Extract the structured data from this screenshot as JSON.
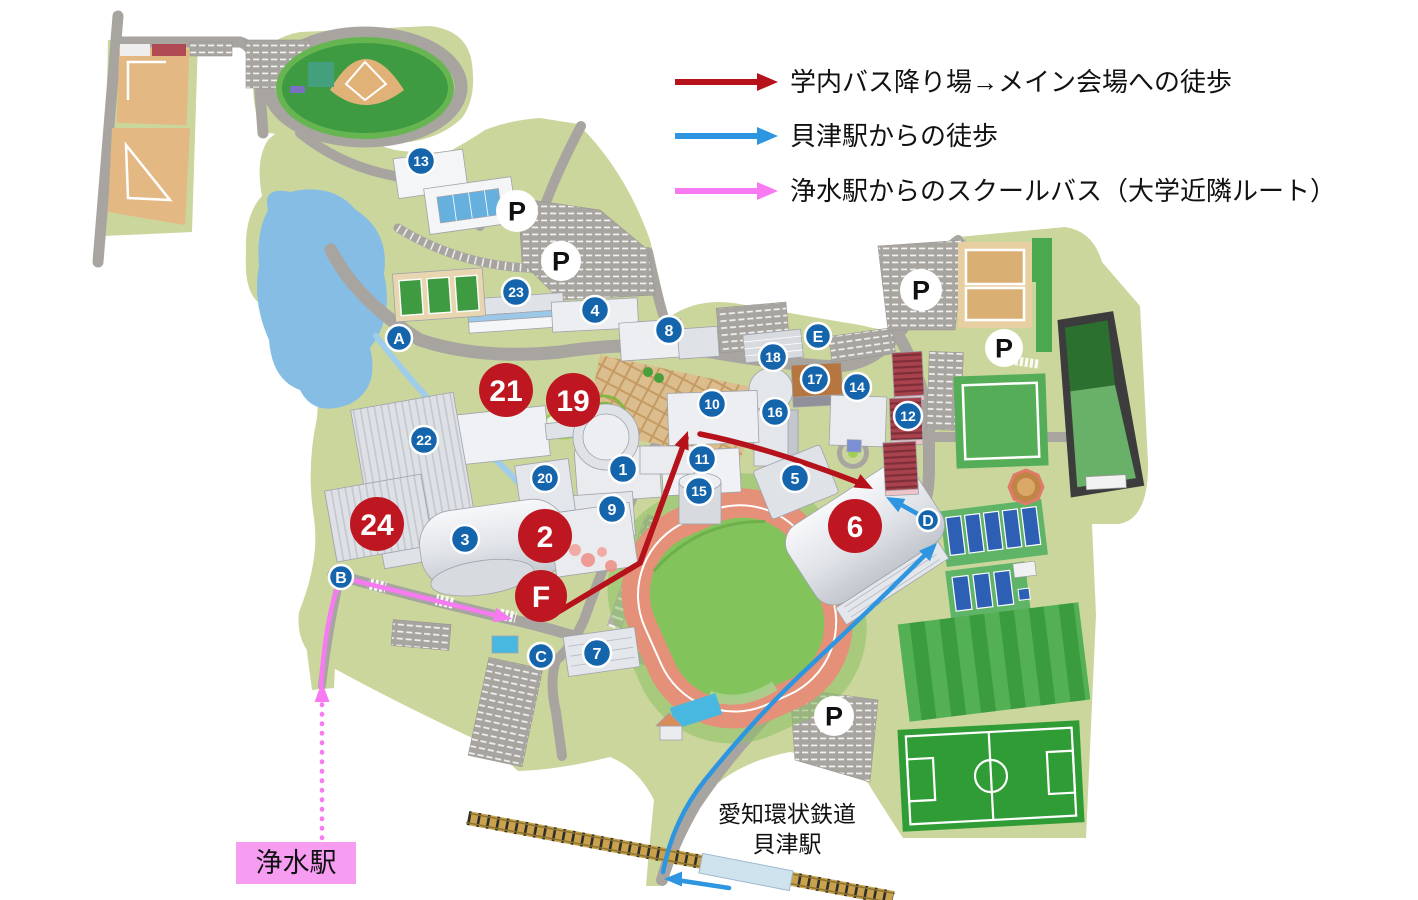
{
  "legend": {
    "items": [
      {
        "id": "campus-bus-walk",
        "color": "#b5121b",
        "label": "学内バス降り場→メイン会場への徒歩"
      },
      {
        "id": "kaizu-station-walk",
        "color": "#2e96e0",
        "label": "貝津駅からの徒歩"
      },
      {
        "id": "josui-school-bus",
        "color": "#f87af2",
        "label": "浄水駅からのスクールバス（大学近隣ルート）"
      }
    ]
  },
  "stations": {
    "josui": "浄水駅",
    "railway_company": "愛知環状鉄道",
    "kaizu": "貝津駅"
  },
  "markers": {
    "parking_label": "P",
    "parking": [
      {
        "x": 517,
        "y": 211,
        "r": 21
      },
      {
        "x": 561,
        "y": 261,
        "r": 20
      },
      {
        "x": 921,
        "y": 290,
        "r": 21
      },
      {
        "x": 1004,
        "y": 348,
        "r": 19
      },
      {
        "x": 834,
        "y": 716,
        "r": 20
      }
    ],
    "letters": [
      {
        "label": "A",
        "x": 399,
        "y": 338,
        "r": 13
      },
      {
        "label": "B",
        "x": 341,
        "y": 577,
        "r": 12
      },
      {
        "label": "C",
        "x": 541,
        "y": 656,
        "r": 13
      },
      {
        "label": "D",
        "x": 928,
        "y": 520,
        "r": 11
      },
      {
        "label": "E",
        "x": 818,
        "y": 336,
        "r": 13
      }
    ],
    "numbered": [
      {
        "label": "1",
        "x": 623,
        "y": 469
      },
      {
        "label": "3",
        "x": 465,
        "y": 539
      },
      {
        "label": "4",
        "x": 595,
        "y": 310
      },
      {
        "label": "5",
        "x": 795,
        "y": 478
      },
      {
        "label": "7",
        "x": 597,
        "y": 653
      },
      {
        "label": "8",
        "x": 669,
        "y": 330
      },
      {
        "label": "9",
        "x": 612,
        "y": 509
      },
      {
        "label": "10",
        "x": 712,
        "y": 404
      },
      {
        "label": "11",
        "x": 702,
        "y": 459
      },
      {
        "label": "12",
        "x": 908,
        "y": 416
      },
      {
        "label": "13",
        "x": 421,
        "y": 161
      },
      {
        "label": "14",
        "x": 857,
        "y": 387
      },
      {
        "label": "15",
        "x": 699,
        "y": 491
      },
      {
        "label": "16",
        "x": 775,
        "y": 412
      },
      {
        "label": "17",
        "x": 815,
        "y": 379
      },
      {
        "label": "18",
        "x": 773,
        "y": 357
      },
      {
        "label": "20",
        "x": 545,
        "y": 478
      },
      {
        "label": "22",
        "x": 424,
        "y": 440
      },
      {
        "label": "23",
        "x": 516,
        "y": 292
      }
    ],
    "venues": [
      {
        "label": "21",
        "x": 506,
        "y": 390,
        "r": 27
      },
      {
        "label": "19",
        "x": 573,
        "y": 400,
        "r": 27
      },
      {
        "label": "24",
        "x": 377,
        "y": 524,
        "r": 27
      },
      {
        "label": "2",
        "x": 545,
        "y": 536,
        "r": 27
      },
      {
        "label": "6",
        "x": 855,
        "y": 526,
        "r": 27
      },
      {
        "label": "F",
        "x": 541,
        "y": 596,
        "r": 26
      }
    ]
  },
  "colors": {
    "marker_blue": "#1565ac",
    "venue_red": "#bf1722",
    "marker_ring": "#ffffff",
    "marker_text": "#ffffff",
    "parking_fill": "#ffffff",
    "parking_text": "#111111",
    "josui_box": "#f79df1",
    "campus_green": "#cbd69d",
    "road_gray": "#a8a5a1"
  }
}
